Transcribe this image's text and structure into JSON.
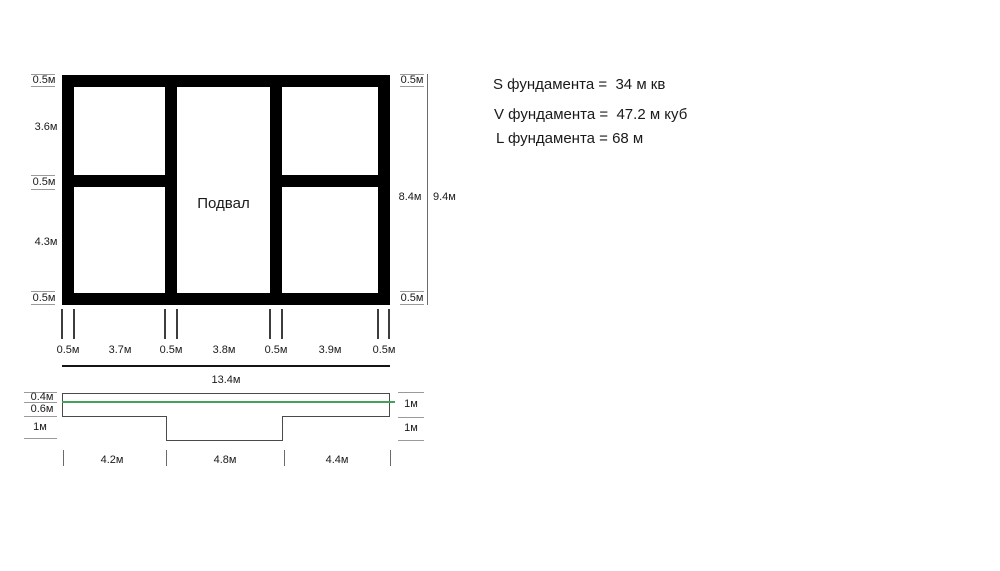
{
  "colors": {
    "wall": "#000000",
    "dim-line": "#9a9a9a",
    "tick": "#3d3d3d",
    "outline": "#4a4a4a",
    "green": "#44a15c",
    "text": "#1a1a1a",
    "total-line": "#151515"
  },
  "plan": {
    "room_label": "Подвал",
    "left_dims": [
      "0.5м",
      "3.6м",
      "0.5м",
      "4.3м",
      "0.5м"
    ],
    "right_dims": [
      "0.5м",
      "8.4м",
      "9.4м",
      "0.5м"
    ],
    "bottom_dims": [
      "0.5м",
      "3.7м",
      "0.5м",
      "3.8м",
      "0.5м",
      "3.9м",
      "0.5м"
    ],
    "total_width": "13.4м"
  },
  "section": {
    "left_dims": [
      "0.4м",
      "0.6м",
      "1м"
    ],
    "right_dims": [
      "1м",
      "1м"
    ],
    "bottom_dims": [
      "4.2м",
      "4.8м",
      "4.4м"
    ]
  },
  "calculations": [
    "S фундамента =  34 м кв",
    "V фундамента =  47.2 м куб",
    "L фундамента = 68 м"
  ]
}
